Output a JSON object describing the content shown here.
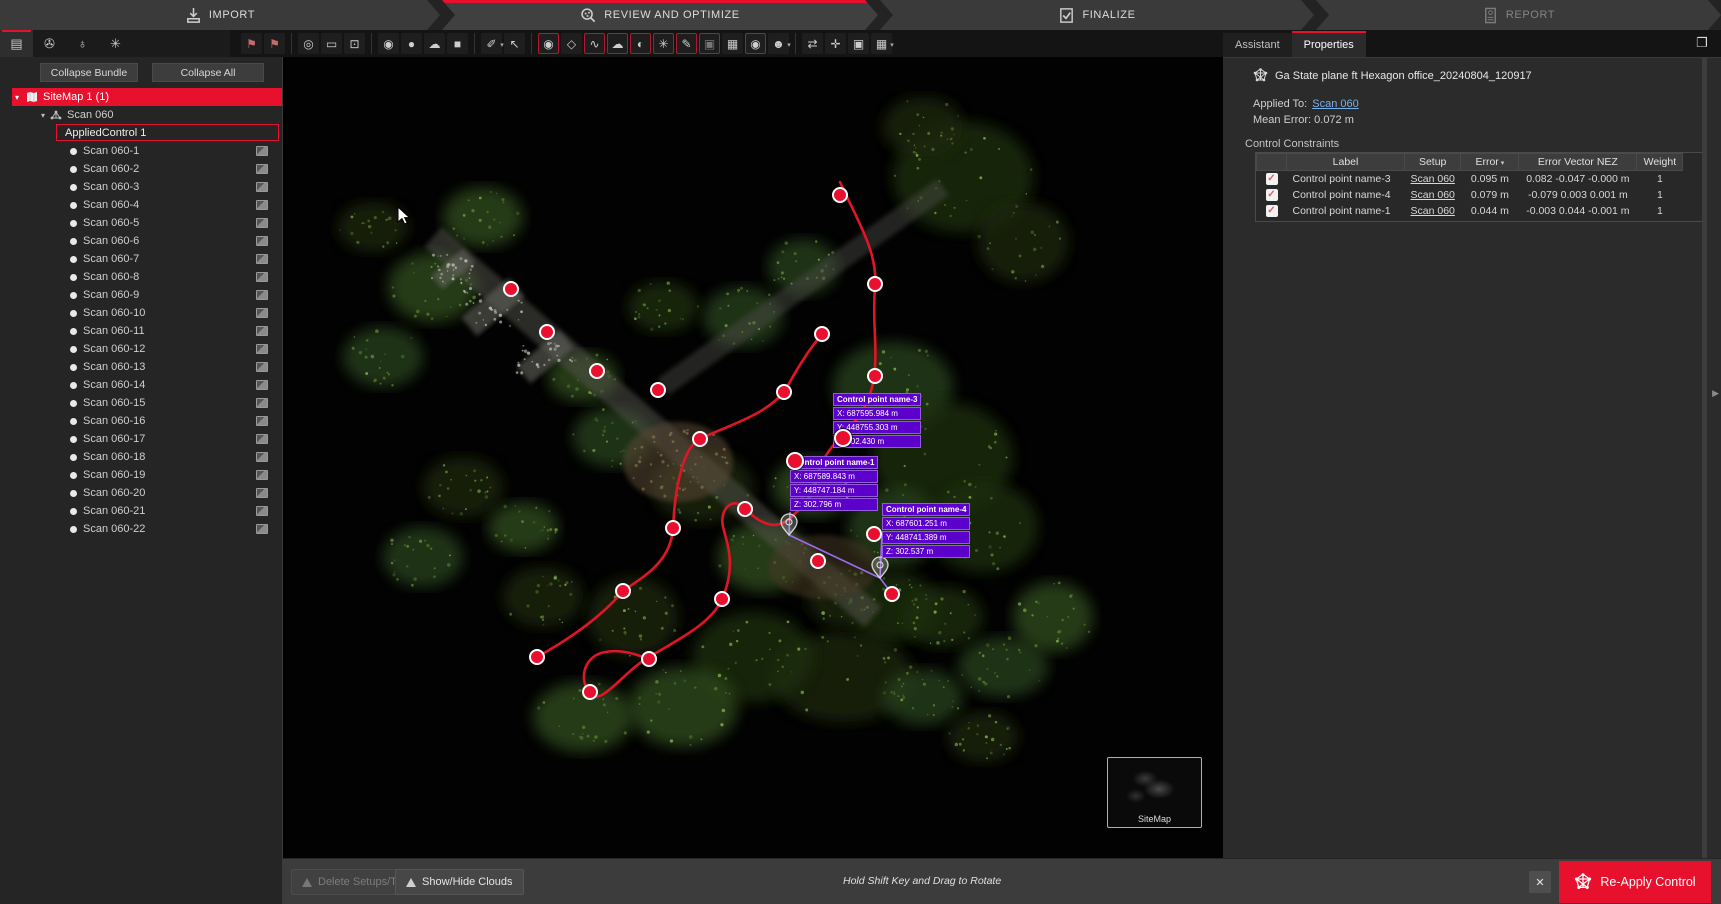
{
  "colors": {
    "accent": "#e8112d",
    "label_purple": "#5c00cb",
    "link_blue": "#7ab0e8",
    "point_red": "#ea0f2e",
    "track_red": "#e01525"
  },
  "workflow": {
    "steps": [
      {
        "label": "IMPORT",
        "icon": "import-icon",
        "active": false,
        "disabled": false
      },
      {
        "label": "REVIEW AND OPTIMIZE",
        "icon": "review-optimize-icon",
        "active": true,
        "disabled": false
      },
      {
        "label": "FINALIZE",
        "icon": "finalize-icon",
        "active": false,
        "disabled": false
      },
      {
        "label": "REPORT",
        "icon": "report-icon",
        "active": false,
        "disabled": true
      }
    ]
  },
  "sidebar": {
    "tabs": [
      {
        "name": "project-explorer-tab",
        "glyph": "▤",
        "active": true
      },
      {
        "name": "attachments-tab",
        "glyph": "✇",
        "active": false
      },
      {
        "name": "geotag-tab",
        "glyph": "♁",
        "active": false
      },
      {
        "name": "bundle-network-tab",
        "glyph": "✳",
        "active": false
      }
    ],
    "collapse_bundle_label": "Collapse Bundle",
    "collapse_all_label": "Collapse All",
    "tree": {
      "root_label": "SiteMap 1 (1)",
      "scan_group_label": "Scan 060",
      "applied_control_label": "AppliedControl 1",
      "scans": [
        "Scan 060-1",
        "Scan 060-2",
        "Scan 060-3",
        "Scan 060-4",
        "Scan 060-5",
        "Scan 060-6",
        "Scan 060-7",
        "Scan 060-8",
        "Scan 060-9",
        "Scan 060-10",
        "Scan 060-11",
        "Scan 060-12",
        "Scan 060-13",
        "Scan 060-14",
        "Scan 060-15",
        "Scan 060-16",
        "Scan 060-17",
        "Scan 060-18",
        "Scan 060-19",
        "Scan 060-20",
        "Scan 060-21",
        "Scan 060-22"
      ]
    }
  },
  "toolbar": {
    "groups": [
      {
        "icons": [
          {
            "name": "sitemap-create-icon",
            "glyph": "⚑",
            "red": true
          },
          {
            "name": "sitemap-open-icon",
            "glyph": "⚑",
            "red": true
          }
        ]
      },
      {
        "icons": [
          {
            "name": "orbit-view-icon",
            "glyph": "◎"
          },
          {
            "name": "frame-view-icon",
            "glyph": "▭"
          },
          {
            "name": "zoom-window-icon",
            "glyph": "⊡"
          }
        ]
      },
      {
        "icons": [
          {
            "name": "multi-sphere-icon",
            "glyph": "◉"
          },
          {
            "name": "sphere-view-icon",
            "glyph": "●"
          },
          {
            "name": "cloud-layers-icon",
            "glyph": "☁"
          },
          {
            "name": "plane-view-icon",
            "glyph": "■"
          }
        ]
      },
      {
        "icons": [
          {
            "name": "measure-icon",
            "glyph": "✐",
            "caret": true
          },
          {
            "name": "select-cursor-icon",
            "glyph": "↖"
          }
        ]
      },
      {
        "icons": [
          {
            "name": "setup-points-toggle-icon",
            "glyph": "◉",
            "on": true
          },
          {
            "name": "tag-toggle-icon",
            "glyph": "◇"
          },
          {
            "name": "track-toggle-icon",
            "glyph": "∿",
            "on": true
          },
          {
            "name": "cloud-toggle-icon",
            "glyph": "☁",
            "on": true
          },
          {
            "name": "sphere-split-toggle-icon",
            "glyph": "◐",
            "on": true
          },
          {
            "name": "control-network-toggle-icon",
            "glyph": "✳",
            "on": true
          },
          {
            "name": "annotation-toggle-icon",
            "glyph": "✎",
            "on": true
          },
          {
            "name": "image-toggle-icon",
            "glyph": "▣",
            "on": true,
            "dim": true
          },
          {
            "name": "camera-toggle-icon",
            "glyph": "▦"
          },
          {
            "name": "pin-toggle-icon",
            "glyph": "◉",
            "on": true
          },
          {
            "name": "user-filter-icon",
            "glyph": "☻",
            "caret": true
          }
        ]
      },
      {
        "icons": [
          {
            "name": "swap-icon",
            "glyph": "⇄"
          },
          {
            "name": "axes-icon",
            "glyph": "✛"
          },
          {
            "name": "snapshot-icon",
            "glyph": "▣"
          },
          {
            "name": "grid-select-icon",
            "glyph": "▦",
            "caret": true
          }
        ]
      }
    ]
  },
  "properties_panel": {
    "tabs": [
      {
        "label": "Assistant",
        "active": false
      },
      {
        "label": "Properties",
        "active": true
      }
    ],
    "copy_icon_glyph": "❐",
    "title": "Ga State plane ft Hexagon office_20240804_120917",
    "applied_to_label": "Applied To:",
    "applied_to_link": "Scan 060",
    "mean_error_label": "Mean Error:",
    "mean_error_value": "0.072 m",
    "section_title": "Control Constraints",
    "table": {
      "columns": [
        "",
        "Label",
        "Setup",
        "Error",
        "Error Vector NEZ",
        "Weight"
      ],
      "rows": [
        {
          "checked": true,
          "label": "Control point name-3",
          "setup": "Scan 060",
          "error": "0.095 m",
          "vector": "0.082 -0.047 -0.000 m",
          "weight": "1"
        },
        {
          "checked": true,
          "label": "Control point name-4",
          "setup": "Scan 060",
          "error": "0.079 m",
          "vector": "-0.079 0.003 0.001 m",
          "weight": "1"
        },
        {
          "checked": true,
          "label": "Control point name-1",
          "setup": "Scan 060",
          "error": "0.044 m",
          "vector": "-0.003 0.044 -0.001 m",
          "weight": "1"
        }
      ]
    }
  },
  "viewport": {
    "sitemap_thumbnail_label": "SiteMap",
    "control_points": [
      [
        557,
        138
      ],
      [
        592,
        227
      ],
      [
        228,
        232
      ],
      [
        264,
        275
      ],
      [
        314,
        314
      ],
      [
        375,
        333
      ],
      [
        592,
        319
      ],
      [
        539,
        277
      ],
      [
        501,
        335
      ],
      [
        417,
        382
      ],
      [
        462,
        452
      ],
      [
        390,
        471
      ],
      [
        340,
        534
      ],
      [
        439,
        542
      ],
      [
        591,
        477
      ],
      [
        535,
        504
      ],
      [
        609,
        537
      ],
      [
        254,
        600
      ],
      [
        366,
        602
      ],
      [
        307,
        635
      ]
    ],
    "overlay_points": [
      [
        560,
        381
      ],
      [
        512,
        404
      ]
    ],
    "pins": [
      [
        506,
        478
      ],
      [
        597,
        521
      ]
    ],
    "point_labels": [
      {
        "title": "Control point name-3",
        "x": "X: 687595.984 m",
        "y": "Y: 448755.303 m",
        "z": "Z: 302.430 m",
        "left": 550,
        "top": 336,
        "width": 80
      },
      {
        "title": "Control point name-1",
        "x": "X: 687589.843 m",
        "y": "Y: 448747.184 m",
        "z": "Z: 302.796 m",
        "left": 507,
        "top": 399,
        "width": 74
      },
      {
        "title": "Control point name-4",
        "x": "X: 687601.251 m",
        "y": "Y: 448741.389 m",
        "z": "Z: 302.537 m",
        "left": 599,
        "top": 446,
        "width": 88
      }
    ]
  },
  "bottom_bar": {
    "delete_button_label": "Delete Setups/Tracks",
    "show_hide_button_label": "Show/Hide Clouds",
    "hint": "Hold Shift Key and Drag to Rotate",
    "close_glyph": "✕",
    "reapply_button_label": "Re-Apply Control"
  }
}
